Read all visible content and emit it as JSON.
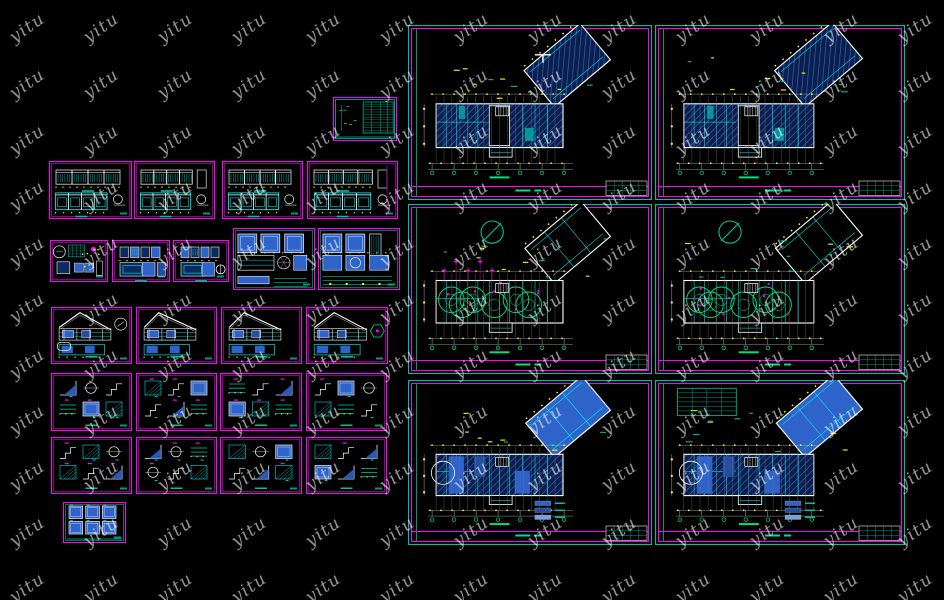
{
  "app": {
    "type": "cad-drawing-sheet-preview",
    "background_color": "#000000"
  },
  "watermark": {
    "text": "yitu",
    "color": "rgba(255,255,255,0.58)",
    "angle_deg": -35
  },
  "colors": {
    "magenta": "#ff00ff",
    "magenta_dim": "#aa00aa",
    "teal": "#00bf9a",
    "teal_dim": "#008a70",
    "cyan": "#00ffff",
    "yellow": "#ffff00",
    "white": "#ffffff",
    "green": "#00e07d",
    "gray": "#8a8a8a",
    "navy": "#0b1f4e",
    "hatch_line": "#3a63b8",
    "blue": "#2e63c9",
    "blue_mid": "#244f9e",
    "blue_light": "#7d9fdd"
  },
  "sheets": {
    "large": [
      {
        "id": "plan-a",
        "kind": "ceiling-plan"
      },
      {
        "id": "plan-b",
        "kind": "ceiling-plan"
      },
      {
        "id": "plan-c",
        "kind": "furniture-plan"
      },
      {
        "id": "plan-d",
        "kind": "furniture-plan"
      },
      {
        "id": "plan-e",
        "kind": "floor-finish-plan"
      },
      {
        "id": "plan-f",
        "kind": "floor-finish-plan"
      }
    ],
    "small": [
      {
        "id": "index-table",
        "kind": "index"
      },
      {
        "id": "elevation-1",
        "kind": "elevation"
      },
      {
        "id": "elevation-2",
        "kind": "elevation"
      },
      {
        "id": "elevation-3",
        "kind": "elevation"
      },
      {
        "id": "elevation-4",
        "kind": "elevation"
      },
      {
        "id": "room-details",
        "kind": "room"
      },
      {
        "id": "interior-elev-1",
        "kind": "elevdark"
      },
      {
        "id": "interior-elev-2",
        "kind": "elevdark"
      },
      {
        "id": "detail-panels-1",
        "kind": "panelgrid"
      },
      {
        "id": "detail-panels-2",
        "kind": "panelgrid"
      },
      {
        "id": "section-1",
        "kind": "section"
      },
      {
        "id": "section-2",
        "kind": "section"
      },
      {
        "id": "section-3",
        "kind": "section"
      },
      {
        "id": "section-4",
        "kind": "section"
      },
      {
        "id": "detail-sheet-1",
        "kind": "details"
      },
      {
        "id": "detail-sheet-2",
        "kind": "details"
      },
      {
        "id": "detail-sheet-3",
        "kind": "details"
      },
      {
        "id": "detail-sheet-4",
        "kind": "details"
      },
      {
        "id": "detail-sheet-5",
        "kind": "details"
      },
      {
        "id": "detail-sheet-6",
        "kind": "details"
      },
      {
        "id": "detail-sheet-7",
        "kind": "details"
      },
      {
        "id": "detail-sheet-8",
        "kind": "details"
      },
      {
        "id": "detail-squares",
        "kind": "squares6"
      }
    ]
  }
}
